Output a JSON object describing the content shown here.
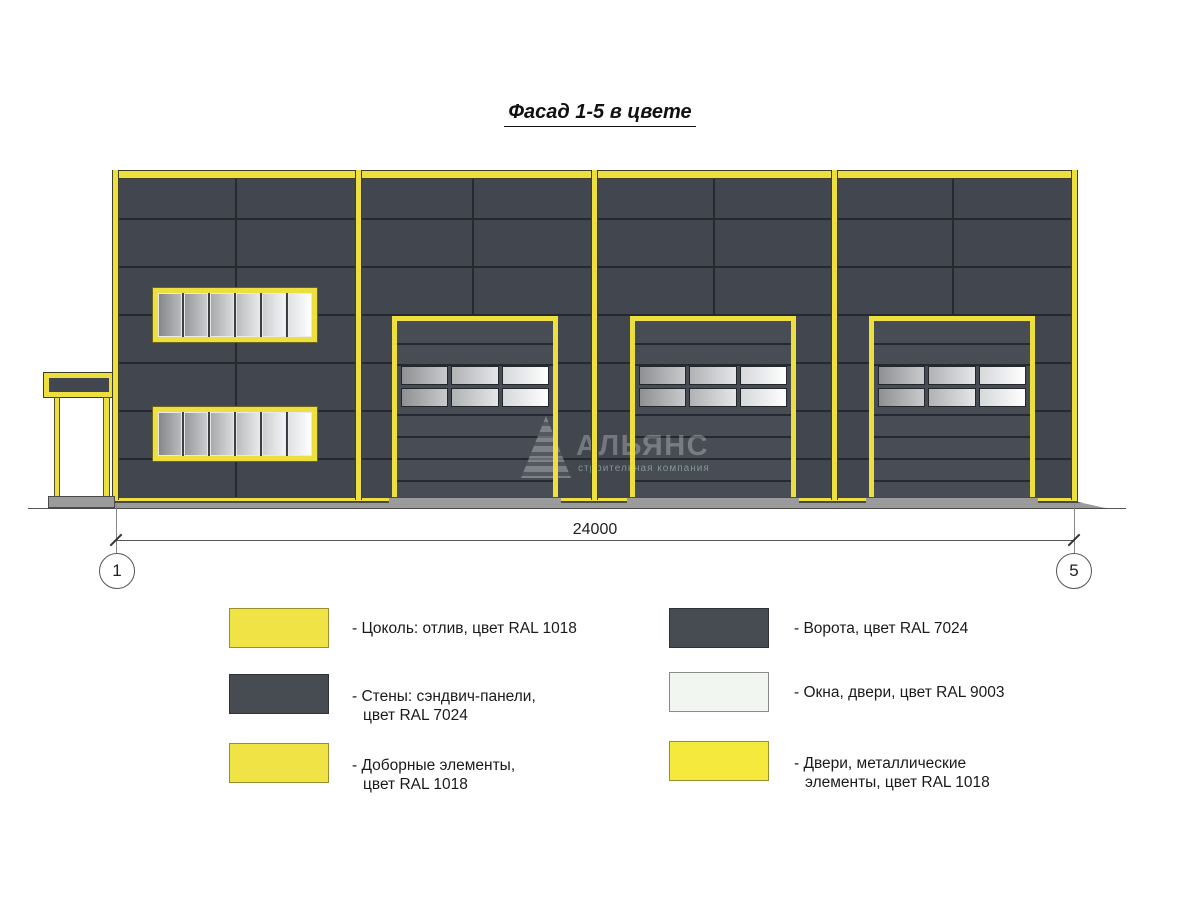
{
  "title": "Фасад 1-5 в цвете",
  "dimension": {
    "value": "24000",
    "axis_start": "1",
    "axis_end": "5"
  },
  "watermark": {
    "name": "АЛЬЯНС",
    "subtitle": "строительная компания"
  },
  "colors": {
    "yellow_ral1018": "#ecdf3e",
    "yellow_edge": "#6b6420",
    "wall_ral7024": "#41464f",
    "wall_joint": "#262a30",
    "door_ral7024": "#474c55",
    "glass_ral9003": "#f1f5f0",
    "ground_gray": "#9b9b9b",
    "line_gray": "#555555"
  },
  "legend": {
    "left": [
      {
        "swatch": "#efe345",
        "edge": "#9a8f2e",
        "lines": [
          "- Цоколь: отлив, цвет RAL 1018"
        ]
      },
      {
        "swatch": "#474b52",
        "edge": "#2f3339",
        "lines": [
          "- Стены: сэндвич-панели,",
          "цвет RAL 7024"
        ]
      },
      {
        "swatch": "#efe345",
        "edge": "#9a8f2e",
        "lines": [
          "- Доборные элементы,",
          "цвет RAL 1018"
        ]
      }
    ],
    "right": [
      {
        "swatch": "#474b52",
        "edge": "#2f3339",
        "lines": [
          "- Ворота, цвет RAL 7024"
        ]
      },
      {
        "swatch": "#f2f6f1",
        "edge": "#8a8a8a",
        "lines": [
          "- Окна, двери, цвет RAL 9003"
        ]
      },
      {
        "swatch": "#f4e93c",
        "edge": "#9a8f2e",
        "lines": [
          "- Двери, металлические",
          "элементы, цвет RAL 1018"
        ]
      }
    ]
  }
}
